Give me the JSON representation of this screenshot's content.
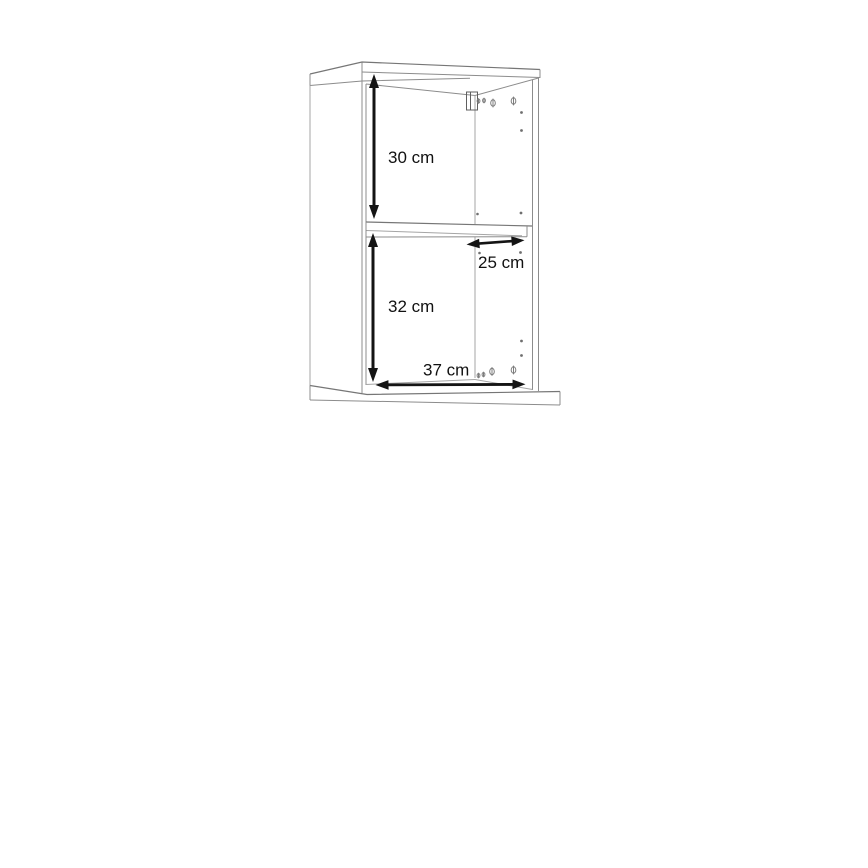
{
  "diagram": {
    "type": "furniture-dimension-drawing",
    "subject": "wall-mounted cabinet with one shelf, perspective interior view",
    "unit": "cm",
    "dimensions": [
      {
        "label": "30 cm",
        "value": 30,
        "unit": "cm",
        "orientation": "vertical",
        "measures": "upper compartment height"
      },
      {
        "label": "25 cm",
        "value": 25,
        "unit": "cm",
        "orientation": "horizontal",
        "measures": "shelf depth"
      },
      {
        "label": "32 cm",
        "value": 32,
        "unit": "cm",
        "orientation": "vertical",
        "measures": "lower compartment height"
      },
      {
        "label": "37 cm",
        "value": 37,
        "unit": "cm",
        "orientation": "horizontal",
        "measures": "interior width"
      }
    ],
    "colors": {
      "background": "#ffffff",
      "cabinet_outline": "#8c8c8c",
      "dimension_marks": "#141414"
    }
  }
}
